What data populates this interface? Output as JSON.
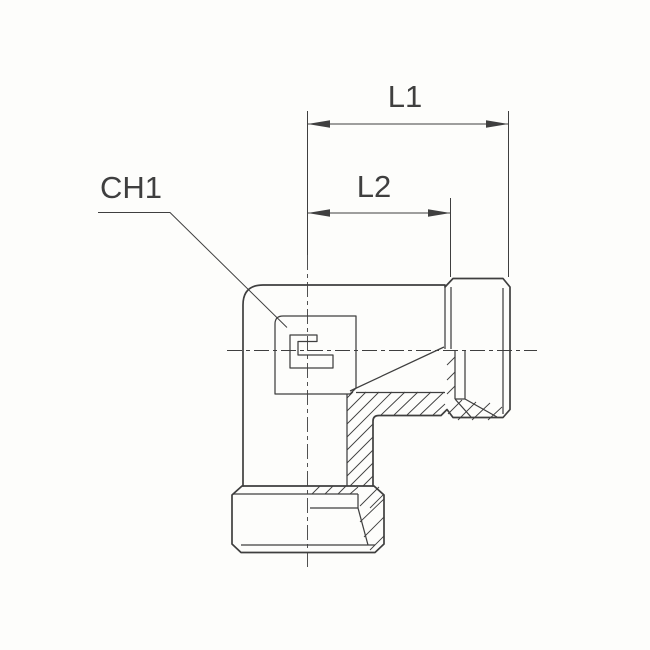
{
  "drawing": {
    "type": "technical-section-drawing",
    "subject": "90-degree elbow tube fitting",
    "dimension_labels": {
      "l1": "L1",
      "l2": "L2",
      "ch1": "CH1"
    },
    "colors": {
      "line": "#3f3f3f",
      "text": "#3f3f3f",
      "background": "#fdfdfb"
    }
  }
}
